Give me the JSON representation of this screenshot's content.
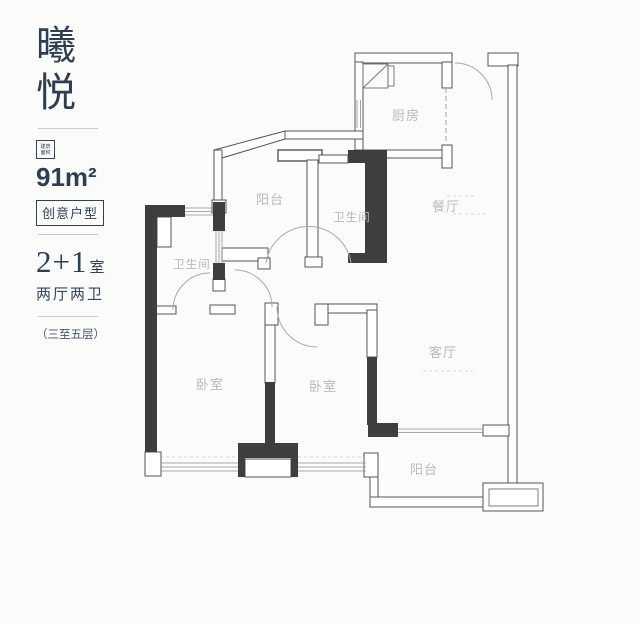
{
  "page": {
    "background": "#fbfbf9"
  },
  "sidebar": {
    "title_char_1": "曦",
    "title_char_2": "悦",
    "badge_line_1": "建筑",
    "badge_line_2": "面积",
    "area": "91m²",
    "tag": "创意户型",
    "layout_number": "2+1",
    "layout_unit": "室",
    "halls_baths": "两厅两卫",
    "floors": "（三至五层）",
    "text_color": "#2c3e54"
  },
  "floorplan": {
    "wall_color": "#3e3e3c",
    "label_color": "#bcbab5",
    "rooms": [
      {
        "id": "kitchen",
        "label": "厨房"
      },
      {
        "id": "dining",
        "label": "餐厅"
      },
      {
        "id": "balcony-top",
        "label": "阳台"
      },
      {
        "id": "bath-middle",
        "label": "卫生间"
      },
      {
        "id": "bath-left",
        "label": "卫生间"
      },
      {
        "id": "bedroom-left",
        "label": "卧室"
      },
      {
        "id": "bedroom-middle",
        "label": "卧室"
      },
      {
        "id": "living",
        "label": "客厅"
      },
      {
        "id": "balcony-bottom",
        "label": "阳台"
      }
    ]
  }
}
